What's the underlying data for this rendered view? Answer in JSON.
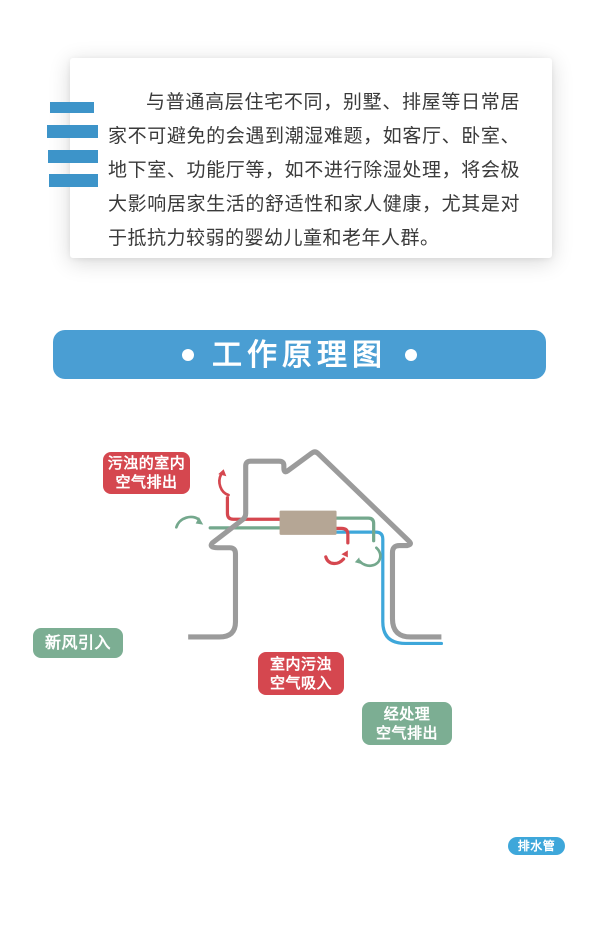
{
  "intro": {
    "paragraph": "与普通高层住宅不同，别墅、排屋等日常居家不可避免的会遇到潮湿难题，如客厅、卧室、地下室、功能厅等，如不进行除湿处理，将会极大影响居家生活的舒适性和家人健康，尤其是对于抵抗力较弱的婴幼儿童和老年人群。"
  },
  "banner": {
    "title": "工作原理图",
    "bullet": "●"
  },
  "diagram": {
    "main_unit_label": "主 机",
    "labels": {
      "exhaust_out_line1": "污浊的室内",
      "exhaust_out_line2": "空气排出",
      "fresh_air_in": "新风引入",
      "indoor_intake_line1": "室内污浊",
      "indoor_intake_line2": "空气吸入",
      "treated_out_line1": "经处理",
      "treated_out_line2": "空气排出",
      "drain_pipe": "排水管"
    },
    "icons": {
      "exhaust_up_arrow": "curved-arrow-up",
      "fresh_air_arrow": "curved-arrow-right",
      "indoor_intake_arrow": "curved-arrow-up-right",
      "treated_out_arrow": "curved-arrow-down-left"
    }
  },
  "colors": {
    "banner_blue": "#4a9ed3",
    "bar_blue": "#3d94c9",
    "pipe_blue": "#3ea7da",
    "red": "#d5474f",
    "green_label": "#7cae93",
    "green_line": "#74a88d",
    "house_gray": "#9b9b9b",
    "main_unit_tan": "#b5a695",
    "text_dark": "#3a3a3a"
  }
}
